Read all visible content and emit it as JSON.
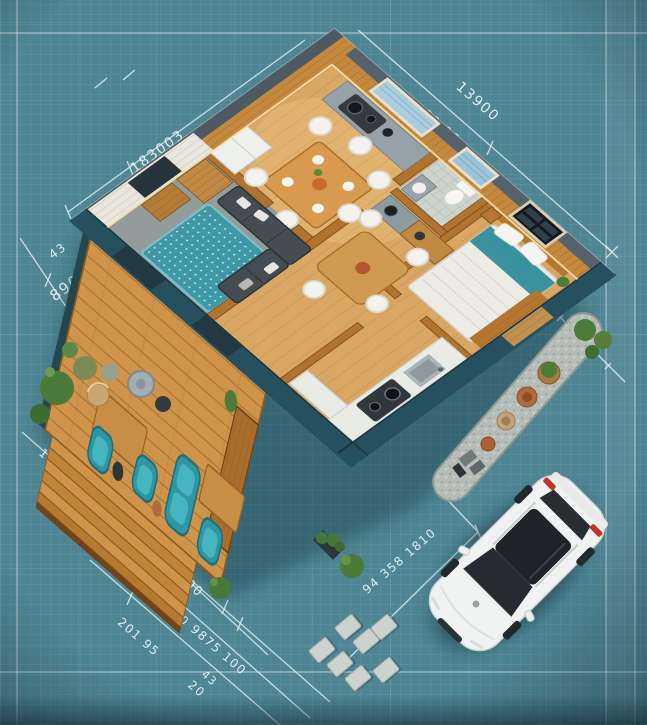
{
  "scene": {
    "description": "Isometric 3D floor plan of a small house on a teal blueprint grid, with wooden deck, teal lounge chairs, garden path with pots, stepping stones and a white car parked at bottom right",
    "style": "blueprint-isometric-render"
  },
  "palette": {
    "blueprint_background": "#4d8592",
    "grid_line": "#ffffff",
    "wall_dark_teal": "#26505d",
    "wood_floor": "#d9a763",
    "wood_wall": "#c4883f",
    "deck_wood": "#cf9449",
    "accent_teal": "#2f97a3",
    "rug_teal": "#3f98a6",
    "sofa_gray": "#454d53",
    "car_white": "#f1f3f2",
    "taillight_red": "#c13528",
    "gravel": "#b6bdb8",
    "plant_green": "#4c7c3a",
    "dimension_text": "#eef6f6"
  },
  "dims": [
    {
      "text": "183003"
    },
    {
      "text": "40 X 80"
    },
    {
      "text": "13900"
    },
    {
      "text": "90 06"
    },
    {
      "text": "200"
    },
    {
      "text": "44"
    },
    {
      "text": "43"
    },
    {
      "text": "890"
    },
    {
      "text": "3"
    },
    {
      "text": "19"
    },
    {
      "text": "90"
    },
    {
      "text": "60"
    },
    {
      "text": "985 X 910 X 1180"
    },
    {
      "text": "201 95"
    },
    {
      "text": "100"
    },
    {
      "text": "9875 100"
    },
    {
      "text": "20"
    },
    {
      "text": "43"
    },
    {
      "text": "94 358 1810"
    },
    {
      "text": "13"
    }
  ]
}
